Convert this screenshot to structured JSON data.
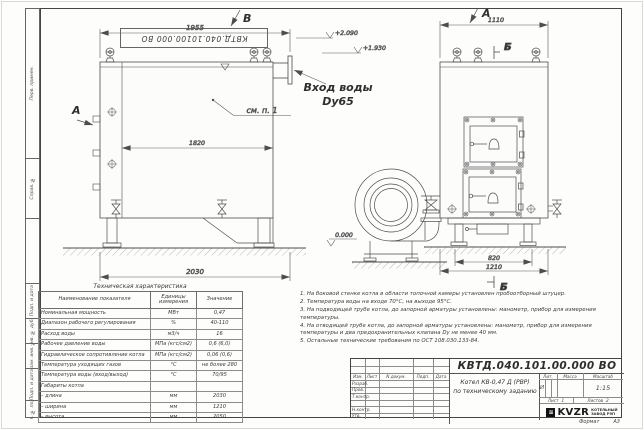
{
  "frame": {
    "top_stamp": "КВТД.040.10100.000 ВО",
    "format_label": "Формат",
    "format_value": "А3",
    "margin_blocks": [
      "Перв. примен.",
      "Справ. №",
      "Подп. и дата",
      "Инв. № дубл.",
      "Взам. инв. №",
      "Подп. и дата",
      "Инв. № подл."
    ]
  },
  "drawing": {
    "view_b": "В",
    "view_a_top": "А",
    "view_a_side": "А",
    "section_b_top": "Б",
    "section_b_bottom": "Б",
    "dim_1955": "1955",
    "dim_1820": "1820",
    "dim_2030": "2030",
    "dim_1110": "1110",
    "dim_820": "820",
    "dim_1210": "1210",
    "level_2090": "+2.090",
    "level_1930": "+1.930",
    "level_0": "0.000",
    "inlet_line1": "Вход воды",
    "inlet_line2": "Dy65",
    "see_note": "см. п. 1"
  },
  "tech_table": {
    "title": "Техническая характеристика",
    "col_name": "Наименование показателя",
    "col_units": "Единицы измерения",
    "col_value": "Значение",
    "rows": [
      {
        "name": "Номинальная мощность",
        "units": "МВт",
        "value": "0,47"
      },
      {
        "name": "Диапазон рабочего регулирования",
        "units": "%",
        "value": "40-110"
      },
      {
        "name": "Расход воды",
        "units": "м3/ч",
        "value": "16"
      },
      {
        "name": "Рабочее давление воды",
        "units": "МПа (кгс/см2)",
        "value": "0,6 (6,0)"
      },
      {
        "name": "Гидравлическое сопротивление котла",
        "units": "МПа (кгс/см2)",
        "value": "0,06 (0,6)"
      },
      {
        "name": "Температура уходящих газов",
        "units": "°С",
        "value": "не более 280"
      },
      {
        "name": "Температура воды (вход/выход)",
        "units": "°С",
        "value": "70/95"
      },
      {
        "name": "Габариты котла",
        "units": "",
        "value": ""
      },
      {
        "name": "– длина",
        "units": "мм",
        "value": "2030"
      },
      {
        "name": "– ширина",
        "units": "мм",
        "value": "1210"
      },
      {
        "name": "– высота",
        "units": "мм",
        "value": "2050"
      }
    ]
  },
  "notes": [
    "1. На боковой стенке котла в области топочной камеры установлен пробоотборный штуцер.",
    "2. Температура воды на входе 70°С, на выходе 95°С.",
    "3. На подводящей трубе котла, до запорной арматуры установлены: манометр, прибор для измерения температуры.",
    "4. На отводящей трубе котла, до запорной арматуры установлены: манометр, прибор для измерения температуры и два предохранительных клапана Dу не менее 40 мм.",
    "5. Остальные технические требования по ОСТ 108.030.133-84."
  ],
  "title_block": {
    "doc_number": "КВТД.040.101.00.000 ВО",
    "title_line1": "Котел КВ-0,47 Д (РВР)",
    "title_line2": "по техническому заданию",
    "header_cols": [
      "Изм.",
      "Лист",
      "N докум.",
      "Подп.",
      "Дата"
    ],
    "row_labels": [
      "Разраб.",
      "Пров.",
      "Т.контр.",
      "Н.контр.",
      "Утв."
    ],
    "lit_label": "Лит.",
    "lit_value": "И",
    "mass_label": "Масса",
    "scale_label": "Масштаб",
    "scale_value": "1:15",
    "sheet_label": "Лист",
    "sheet_value": "1",
    "sheets_label": "Листов",
    "sheets_value": "2",
    "company_logo": "KVZR",
    "company_line1": "КОТЕЛЬНЫЙ",
    "company_line2": "ЗАВОД РЭП"
  }
}
